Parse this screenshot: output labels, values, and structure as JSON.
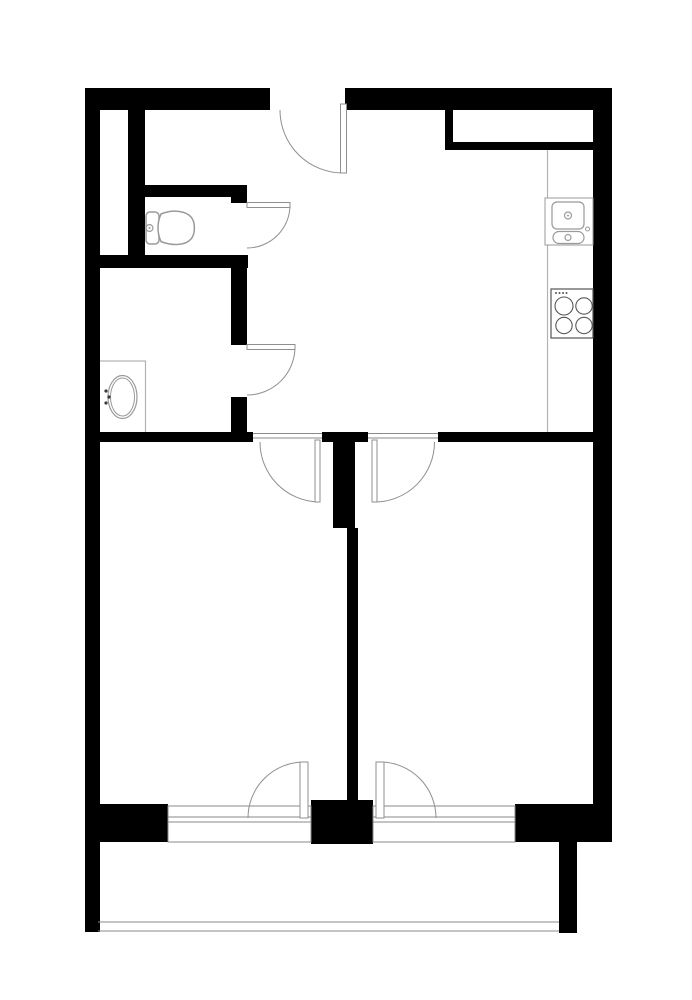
{
  "title": "apartment-floor-plan",
  "canvas": {
    "width": 692,
    "height": 1000,
    "background": "#ffffff"
  },
  "colors": {
    "wall": "#000000",
    "floor": "#ffffff",
    "door": "#8f8f8f",
    "window": "#8a8a8a",
    "fixture": "#9a9a9a",
    "appliance": "#555555",
    "counter": "#b3b3b3",
    "dot": "#3a3a3a"
  },
  "plan": {
    "elements": [
      {
        "name": "top-wall-left",
        "type": "rect",
        "x": 85,
        "y": 88,
        "w": 185,
        "h": 22,
        "fill": "wall"
      },
      {
        "name": "top-wall-right",
        "type": "rect",
        "x": 345,
        "y": 88,
        "w": 267,
        "h": 22,
        "fill": "wall"
      },
      {
        "name": "left-outer-wall",
        "type": "rect",
        "x": 85,
        "y": 88,
        "w": 15,
        "h": 844,
        "fill": "wall"
      },
      {
        "name": "right-outer-wall",
        "type": "rect",
        "x": 593,
        "y": 110,
        "w": 19,
        "h": 732,
        "fill": "wall"
      },
      {
        "name": "niche-left-jamb",
        "type": "rect",
        "x": 445,
        "y": 110,
        "w": 8,
        "h": 40,
        "fill": "wall"
      },
      {
        "name": "niche-bottom-wall",
        "type": "rect",
        "x": 445,
        "y": 142,
        "w": 150,
        "h": 8,
        "fill": "wall"
      },
      {
        "name": "hall-inner-wall",
        "type": "rect",
        "x": 128,
        "y": 110,
        "w": 17,
        "h": 158,
        "fill": "wall"
      },
      {
        "name": "wc-top-wall",
        "type": "rect",
        "x": 128,
        "y": 185,
        "w": 103,
        "h": 12,
        "fill": "wall"
      },
      {
        "name": "wc-door-stub",
        "type": "rect",
        "x": 231,
        "y": 185,
        "w": 16,
        "h": 18,
        "fill": "wall"
      },
      {
        "name": "wc-bottom-wall",
        "type": "rect",
        "x": 98,
        "y": 255,
        "w": 150,
        "h": 13,
        "fill": "wall"
      },
      {
        "name": "bath-right-wall-upper",
        "type": "rect",
        "x": 231,
        "y": 262,
        "w": 16,
        "h": 83,
        "fill": "wall"
      },
      {
        "name": "bath-right-wall-lower",
        "type": "rect",
        "x": 231,
        "y": 397,
        "w": 16,
        "h": 35,
        "fill": "wall"
      },
      {
        "name": "divider-wall-left",
        "type": "rect",
        "x": 85,
        "y": 432,
        "w": 168,
        "h": 10,
        "fill": "wall"
      },
      {
        "name": "divider-wall-mid",
        "type": "rect",
        "x": 322,
        "y": 432,
        "w": 46,
        "h": 10,
        "fill": "wall"
      },
      {
        "name": "divider-wall-right",
        "type": "rect",
        "x": 438,
        "y": 432,
        "w": 157,
        "h": 10,
        "fill": "wall"
      },
      {
        "name": "center-wall-upper",
        "type": "rect",
        "x": 333,
        "y": 442,
        "w": 22,
        "h": 86,
        "fill": "wall"
      },
      {
        "name": "center-wall-lower",
        "type": "rect",
        "x": 347,
        "y": 528,
        "w": 11,
        "h": 277,
        "fill": "wall"
      },
      {
        "name": "bottom-wall-left",
        "type": "rect",
        "x": 85,
        "y": 804,
        "w": 83,
        "h": 38,
        "fill": "wall"
      },
      {
        "name": "bottom-wall-pier",
        "type": "rect",
        "x": 311,
        "y": 800,
        "w": 62,
        "h": 44,
        "fill": "wall"
      },
      {
        "name": "bottom-wall-right",
        "type": "rect",
        "x": 515,
        "y": 804,
        "w": 97,
        "h": 38,
        "fill": "wall"
      },
      {
        "name": "balcony-left-wall",
        "type": "rect",
        "x": 85,
        "y": 842,
        "w": 13,
        "h": 90,
        "fill": "wall"
      },
      {
        "name": "balcony-right-wall",
        "type": "rect",
        "x": 559,
        "y": 842,
        "w": 18,
        "h": 91,
        "fill": "wall"
      },
      {
        "name": "kitchen-counter-edge",
        "type": "line",
        "x1": 547.5,
        "y1": 150,
        "x2": 547.5,
        "y2": 432,
        "stroke": "counter",
        "sw": 1.2
      },
      {
        "name": "window-left-frame",
        "type": "rect",
        "x": 168,
        "y": 806,
        "w": 143,
        "h": 36,
        "fill": "floor",
        "stroke": "window",
        "sw": 1
      },
      {
        "name": "window-left-line1",
        "type": "line",
        "x1": 168,
        "y1": 817,
        "x2": 311,
        "y2": 817,
        "stroke": "window",
        "sw": 1
      },
      {
        "name": "window-left-line2",
        "type": "line",
        "x1": 168,
        "y1": 822,
        "x2": 311,
        "y2": 822,
        "stroke": "window",
        "sw": 1
      },
      {
        "name": "window-right-frame",
        "type": "rect",
        "x": 373,
        "y": 806,
        "w": 142,
        "h": 36,
        "fill": "floor",
        "stroke": "window",
        "sw": 1
      },
      {
        "name": "window-right-line1",
        "type": "line",
        "x1": 373,
        "y1": 817,
        "x2": 515,
        "y2": 817,
        "stroke": "window",
        "sw": 1
      },
      {
        "name": "window-right-line2",
        "type": "line",
        "x1": 373,
        "y1": 822,
        "x2": 515,
        "y2": 822,
        "stroke": "window",
        "sw": 1
      },
      {
        "name": "balcony-front-outer",
        "type": "line",
        "x1": 98,
        "y1": 922,
        "x2": 559,
        "y2": 922,
        "stroke": "window",
        "sw": 1
      },
      {
        "name": "balcony-front-inner",
        "type": "line",
        "x1": 98,
        "y1": 931,
        "x2": 559,
        "y2": 931,
        "stroke": "window",
        "sw": 1
      },
      {
        "name": "bedroom-left-threshold-a",
        "type": "line",
        "x1": 253,
        "y1": 433.5,
        "x2": 322,
        "y2": 433.5,
        "stroke": "window",
        "sw": 1
      },
      {
        "name": "bedroom-left-threshold-b",
        "type": "line",
        "x1": 253,
        "y1": 438,
        "x2": 322,
        "y2": 438,
        "stroke": "window",
        "sw": 1
      },
      {
        "name": "bedroom-right-threshold-a",
        "type": "line",
        "x1": 368,
        "y1": 433.5,
        "x2": 438,
        "y2": 433.5,
        "stroke": "window",
        "sw": 1
      },
      {
        "name": "bedroom-right-threshold-b",
        "type": "line",
        "x1": 368,
        "y1": 438,
        "x2": 438,
        "y2": 438,
        "stroke": "window",
        "sw": 1
      },
      {
        "name": "entry-door-arc",
        "type": "path",
        "d": "M 280 110 A 63 63 0 0 0 343.5 173",
        "stroke": "door",
        "sw": 1,
        "fill": "none"
      },
      {
        "name": "entry-door-leaf",
        "type": "rect",
        "x": 340.5,
        "y": 104,
        "w": 6,
        "h": 69,
        "fill": "floor",
        "stroke": "door",
        "sw": 1
      },
      {
        "name": "wc-door-arc",
        "type": "path",
        "d": "M 290 205 A 43 43 0 0 1 247 248",
        "stroke": "door",
        "sw": 1,
        "fill": "none"
      },
      {
        "name": "wc-door-leaf",
        "type": "rect",
        "x": 247,
        "y": 202.5,
        "w": 43,
        "h": 5,
        "fill": "floor",
        "stroke": "door",
        "sw": 1
      },
      {
        "name": "bath-door-arc",
        "type": "path",
        "d": "M 295 347 A 48 48 0 0 1 247 395",
        "stroke": "door",
        "sw": 1,
        "fill": "none"
      },
      {
        "name": "bath-door-leaf",
        "type": "rect",
        "x": 247,
        "y": 344.5,
        "w": 48,
        "h": 5,
        "fill": "floor",
        "stroke": "door",
        "sw": 1
      },
      {
        "name": "bedroom-left-door-arc",
        "type": "path",
        "d": "M 318 502 A 60 60 0 0 1 260 442",
        "stroke": "door",
        "sw": 1,
        "fill": "none"
      },
      {
        "name": "bedroom-left-door-leaf",
        "type": "rect",
        "x": 315,
        "y": 440,
        "w": 5,
        "h": 62,
        "fill": "floor",
        "stroke": "door",
        "sw": 1
      },
      {
        "name": "bedroom-right-door-arc",
        "type": "path",
        "d": "M 374.5 502 A 60 60 0 0 0 434.5 442",
        "stroke": "door",
        "sw": 1,
        "fill": "none"
      },
      {
        "name": "bedroom-right-door-leaf",
        "type": "rect",
        "x": 372,
        "y": 440,
        "w": 5,
        "h": 62,
        "fill": "floor",
        "stroke": "door",
        "sw": 1
      },
      {
        "name": "balcony-left-door-arc",
        "type": "path",
        "d": "M 304 762 A 56 56 0 0 0 248 818",
        "stroke": "door",
        "sw": 1,
        "fill": "none"
      },
      {
        "name": "balcony-left-door-leaf",
        "type": "rect",
        "x": 300,
        "y": 762,
        "w": 8,
        "h": 56,
        "fill": "floor",
        "stroke": "door",
        "sw": 1
      },
      {
        "name": "balcony-right-door-arc",
        "type": "path",
        "d": "M 380 762 A 56 56 0 0 1 436 818",
        "stroke": "door",
        "sw": 1,
        "fill": "none"
      },
      {
        "name": "balcony-right-door-leaf",
        "type": "rect",
        "x": 376,
        "y": 762,
        "w": 8,
        "h": 56,
        "fill": "floor",
        "stroke": "door",
        "sw": 1
      },
      {
        "name": "toilet-tank",
        "type": "rect",
        "x": 146,
        "y": 212,
        "w": 13,
        "h": 32,
        "rx": 4,
        "fill": "floor",
        "stroke": "fixture",
        "sw": 1.5
      },
      {
        "name": "toilet-flush-button",
        "type": "circle",
        "cx": 149.5,
        "cy": 228,
        "r": 3.4,
        "fill": "floor",
        "stroke": "fixture",
        "sw": 1.2
      },
      {
        "name": "toilet-flush-dot",
        "type": "circle",
        "cx": 149.5,
        "cy": 228,
        "r": 1,
        "fill": "fixture",
        "stroke": "none",
        "sw": 0
      },
      {
        "name": "toilet-bowl",
        "type": "path",
        "d": "M 161 214 C 173 209 186 211 191 217 C 195.5 222 195.5 234 191 239 C 186 245 173 246.5 161 241.5 C 157 233 157 222.5 161 214 Z",
        "fill": "floor",
        "stroke": "fixture",
        "sw": 1.5
      },
      {
        "name": "bath-counter-outline",
        "type": "path",
        "d": "M 100 361 L 145.5 361 L 145.5 432",
        "fill": "none",
        "stroke": "counter",
        "sw": 1.2
      },
      {
        "name": "bath-sink-outer",
        "type": "ellipse",
        "cx": 122.5,
        "cy": 397,
        "rx": 14.5,
        "ry": 21.5,
        "fill": "floor",
        "stroke": "fixture",
        "sw": 1.2
      },
      {
        "name": "bath-sink-inner",
        "type": "ellipse",
        "cx": 122.5,
        "cy": 397,
        "rx": 12,
        "ry": 19,
        "fill": "none",
        "stroke": "fixture",
        "sw": 1
      },
      {
        "name": "bath-faucet-dot-1",
        "type": "circle",
        "cx": 106,
        "cy": 391,
        "r": 1.6,
        "fill": "dot",
        "stroke": "none",
        "sw": 0
      },
      {
        "name": "bath-faucet-dot-2",
        "type": "circle",
        "cx": 109,
        "cy": 397,
        "r": 1.6,
        "fill": "dot",
        "stroke": "none",
        "sw": 0
      },
      {
        "name": "bath-faucet-dot-3",
        "type": "circle",
        "cx": 106,
        "cy": 403,
        "r": 1.6,
        "fill": "dot",
        "stroke": "none",
        "sw": 0
      },
      {
        "name": "kitchen-sink-unit",
        "type": "rect",
        "x": 545,
        "y": 198,
        "w": 48,
        "h": 47,
        "fill": "floor",
        "stroke": "fixture",
        "sw": 1
      },
      {
        "name": "kitchen-sink-basin",
        "type": "rect",
        "x": 552,
        "y": 202,
        "w": 32,
        "h": 27,
        "rx": 5,
        "fill": "floor",
        "stroke": "fixture",
        "sw": 1.2
      },
      {
        "name": "kitchen-sink-drain",
        "type": "circle",
        "cx": 568,
        "cy": 215.5,
        "r": 3.5,
        "fill": "floor",
        "stroke": "fixture",
        "sw": 1.2
      },
      {
        "name": "kitchen-sink-drain-dot",
        "type": "circle",
        "cx": 568,
        "cy": 215.5,
        "r": 1,
        "fill": "fixture",
        "stroke": "none",
        "sw": 0
      },
      {
        "name": "kitchen-sink-basin2",
        "type": "rect",
        "x": 553,
        "y": 231.5,
        "w": 31,
        "h": 12,
        "rx": 6,
        "fill": "floor",
        "stroke": "fixture",
        "sw": 1.2
      },
      {
        "name": "kitchen-sink-drain2",
        "type": "circle",
        "cx": 568,
        "cy": 237.5,
        "r": 3,
        "fill": "floor",
        "stroke": "fixture",
        "sw": 1.2
      },
      {
        "name": "kitchen-faucet",
        "type": "circle",
        "cx": 587.5,
        "cy": 229,
        "r": 2,
        "fill": "floor",
        "stroke": "fixture",
        "sw": 1
      },
      {
        "name": "stove-unit",
        "type": "rect",
        "x": 551,
        "y": 289,
        "w": 42,
        "h": 49,
        "fill": "floor",
        "stroke": "appliance",
        "sw": 1.2
      },
      {
        "name": "stove-burner-1",
        "type": "circle",
        "cx": 564,
        "cy": 306,
        "r": 9,
        "fill": "floor",
        "stroke": "appliance",
        "sw": 1.1
      },
      {
        "name": "stove-burner-2",
        "type": "circle",
        "cx": 584,
        "cy": 306,
        "r": 8.2,
        "fill": "floor",
        "stroke": "appliance",
        "sw": 1.1
      },
      {
        "name": "stove-burner-3",
        "type": "circle",
        "cx": 564,
        "cy": 325.5,
        "r": 8.2,
        "fill": "floor",
        "stroke": "appliance",
        "sw": 1.1
      },
      {
        "name": "stove-burner-4",
        "type": "circle",
        "cx": 584,
        "cy": 325.5,
        "r": 8.2,
        "fill": "floor",
        "stroke": "appliance",
        "sw": 1.1
      },
      {
        "name": "stove-knob-1",
        "type": "circle",
        "cx": 556,
        "cy": 293,
        "r": 1,
        "fill": "appliance",
        "stroke": "none",
        "sw": 0
      },
      {
        "name": "stove-knob-2",
        "type": "circle",
        "cx": 559.5,
        "cy": 293,
        "r": 1,
        "fill": "appliance",
        "stroke": "none",
        "sw": 0
      },
      {
        "name": "stove-knob-3",
        "type": "circle",
        "cx": 563,
        "cy": 293,
        "r": 1,
        "fill": "appliance",
        "stroke": "none",
        "sw": 0
      },
      {
        "name": "stove-knob-4",
        "type": "circle",
        "cx": 566.5,
        "cy": 293,
        "r": 1,
        "fill": "appliance",
        "stroke": "none",
        "sw": 0
      }
    ]
  }
}
